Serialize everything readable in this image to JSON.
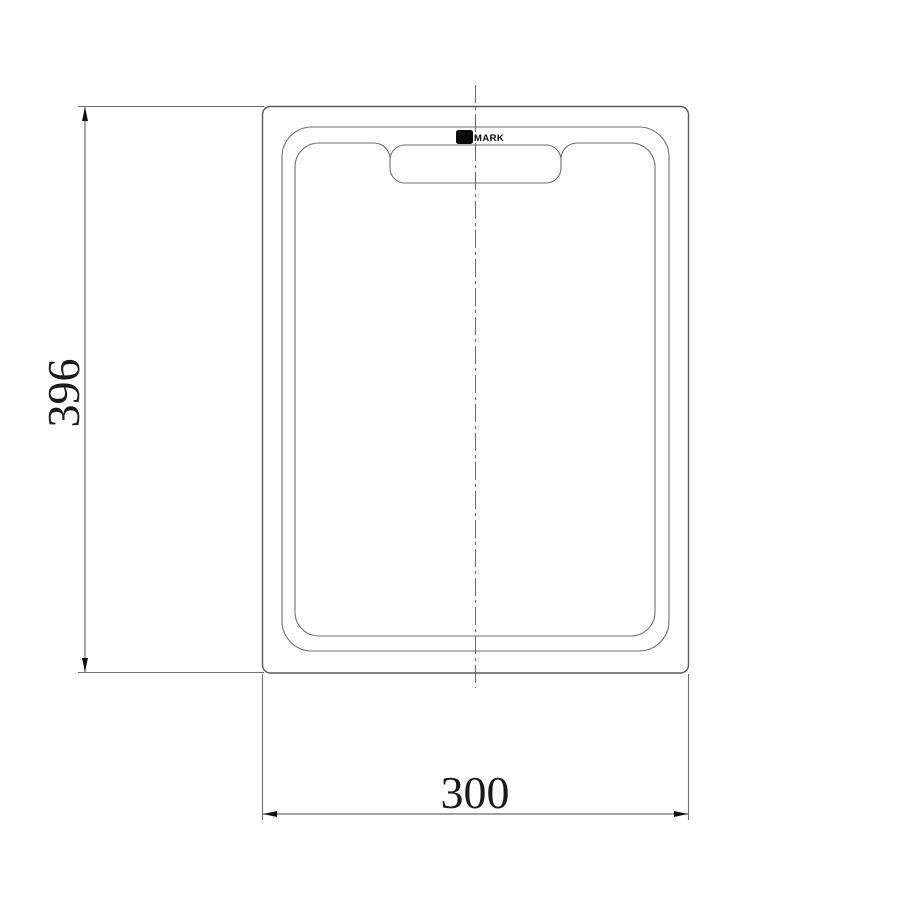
{
  "page": {
    "background": "#ffffff",
    "kind": "technical line drawing of a rectangular cutting board with handle cutout, front view with dimensions"
  },
  "drawing": {
    "logo": {
      "label": "MARK",
      "icon": "brand-logo-square"
    },
    "dimensions": {
      "height_label": "396",
      "width_label": "300"
    },
    "colors": {
      "outline": "#5a5a5a",
      "rim": "#6f6f6f",
      "dimension_line": "#6e6e6e",
      "extension_line": "#6e6e6e",
      "centerline": "#6a6a6a",
      "arrow": "#111111",
      "dimension_text": "#1a1a1a",
      "logo": "#0a0a0a"
    }
  }
}
